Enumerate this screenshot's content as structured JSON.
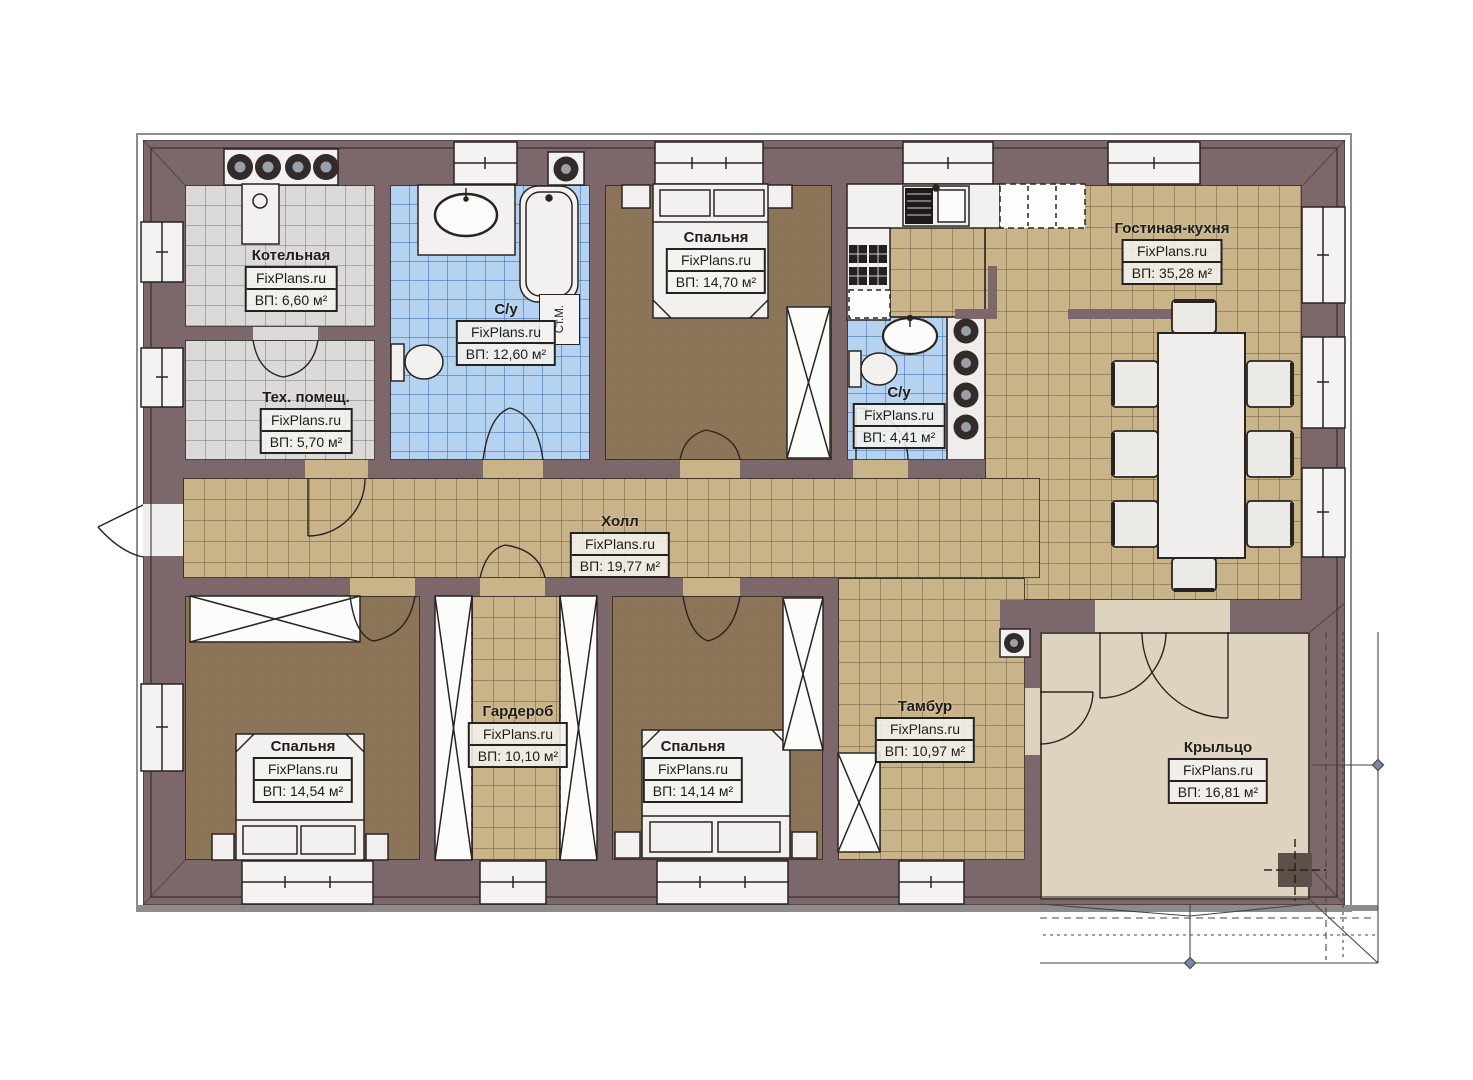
{
  "site": {
    "brand": "FixPlans.ru"
  },
  "labels": {
    "washing_machine": "Ст.М."
  },
  "colors": {
    "wall": "#7c676a",
    "hall_tile": "#c9b489",
    "bath_tile": "#b5d3f1",
    "utility_tile": "#dbdad8",
    "bedroom_floor": "#8b7457",
    "porch_floor": "#ded3bf",
    "furniture": "#f2f1ef",
    "line": "#2a2421"
  },
  "rooms": [
    {
      "id": "kotelnaya",
      "name": "Котельная",
      "brand": "FixPlans.ru",
      "area": "ВП: 6,60 м²"
    },
    {
      "id": "teh",
      "name": "Тех. помещ.",
      "brand": "FixPlans.ru",
      "area": "ВП: 5,70 м²"
    },
    {
      "id": "su1",
      "name": "С/у",
      "brand": "FixPlans.ru",
      "area": "ВП: 12,60 м²"
    },
    {
      "id": "bedtop",
      "name": "Спальня",
      "brand": "FixPlans.ru",
      "area": "ВП: 14,70 м²"
    },
    {
      "id": "su2",
      "name": "С/у",
      "brand": "FixPlans.ru",
      "area": "ВП: 4,41 м²"
    },
    {
      "id": "living",
      "name": "Гостиная-кухня",
      "brand": "FixPlans.ru",
      "area": "ВП: 35,28 м²"
    },
    {
      "id": "hall",
      "name": "Холл",
      "brand": "FixPlans.ru",
      "area": "ВП: 19,77 м²"
    },
    {
      "id": "wardrobe",
      "name": "Гардероб",
      "brand": "FixPlans.ru",
      "area": "ВП: 10,10 м²"
    },
    {
      "id": "bed1",
      "name": "Спальня",
      "brand": "FixPlans.ru",
      "area": "ВП: 14,54 м²"
    },
    {
      "id": "bed2",
      "name": "Спальня",
      "brand": "FixPlans.ru",
      "area": "ВП: 14,14 м²"
    },
    {
      "id": "tambur",
      "name": "Тамбур",
      "brand": "FixPlans.ru",
      "area": "ВП: 10,97 м²"
    },
    {
      "id": "porch",
      "name": "Крыльцо",
      "brand": "FixPlans.ru",
      "area": "ВП: 16,81 м²"
    }
  ]
}
